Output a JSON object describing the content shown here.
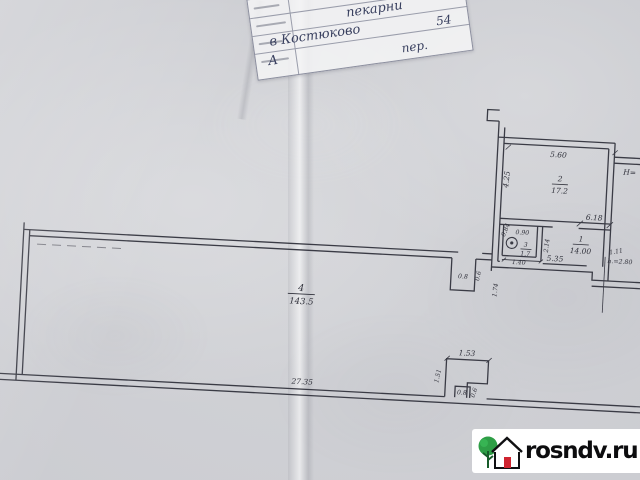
{
  "stamp": {
    "line1": "нае",
    "name": "пекарни",
    "street": "в Костюково",
    "number": "54",
    "liter": "А",
    "lane": "пер."
  },
  "plan": {
    "rooms": {
      "hall": {
        "num": "4",
        "area": "143.5"
      },
      "room1": {
        "num": "1",
        "area": "14.00"
      },
      "room2": {
        "num": "2",
        "area": "17.2"
      },
      "closet": {
        "num": "3",
        "area": "1.7"
      }
    },
    "dims": {
      "hall_width": "27.35",
      "room2_width": "5.60",
      "room2_depth": "4.25",
      "door_span": "6.18",
      "right_jamb": "1.11",
      "room1_width": "5.35",
      "ceiling_height": "h.=2.80",
      "closet_top": "0.90",
      "closet_right": "2.14",
      "closet_bottom": "1.40",
      "closet_left": "1.74",
      "stove_side": "0.84",
      "notch_width": "0.8",
      "notch_side": "0.6",
      "porch_top": "1.53",
      "porch_side": "1.51",
      "porch_tab": "0.8",
      "porch_tab_side": "0.6",
      "elevation_mark": "Н="
    }
  },
  "watermark": {
    "text": "rosndv.ru"
  }
}
